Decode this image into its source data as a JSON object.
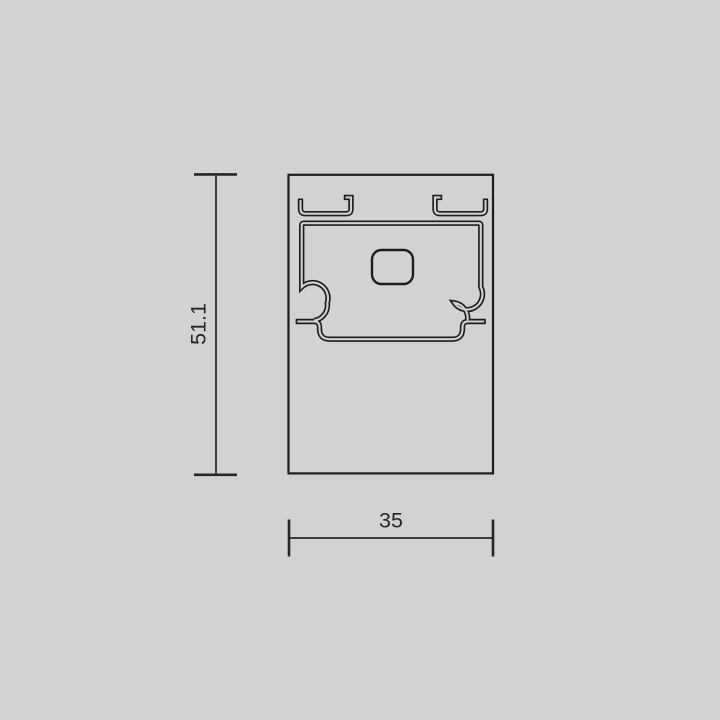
{
  "dimensions": {
    "height": "51.1",
    "width": "35"
  },
  "colors": {
    "background": "#d2d2d2",
    "line": "#1d1d1d",
    "text": "#262626"
  }
}
